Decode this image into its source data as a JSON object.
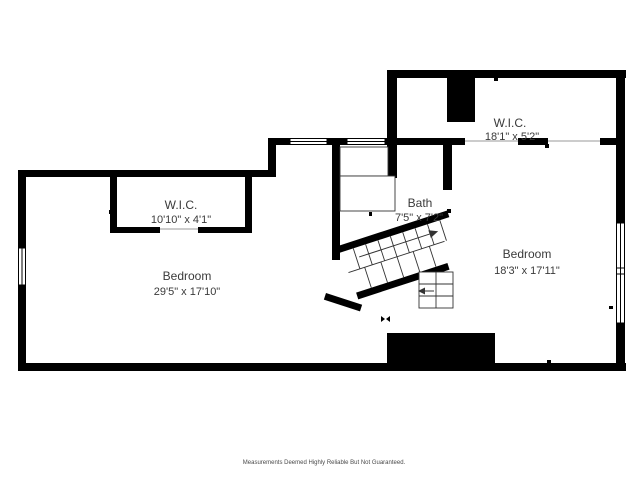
{
  "rooms": [
    {
      "name": "W.I.C.",
      "dimensions": "10'10\" x 4'1\""
    },
    {
      "name": "Bedroom",
      "dimensions": "29'5\" x 17'10\""
    },
    {
      "name": "W.I.C.",
      "dimensions": "18'1\" x 5'2\""
    },
    {
      "name": "Bath",
      "dimensions": "7'5\" x 7'2\""
    },
    {
      "name": "Bedroom",
      "dimensions": "18'3\" x 17'11\""
    }
  ],
  "footer": "Measurements Deemed Highly Reliable But Not Guaranteed.",
  "colors": {
    "wall": "#000000",
    "background": "#ffffff",
    "label_text": "#3a3a3a",
    "footer_text": "#4a4a4a"
  }
}
